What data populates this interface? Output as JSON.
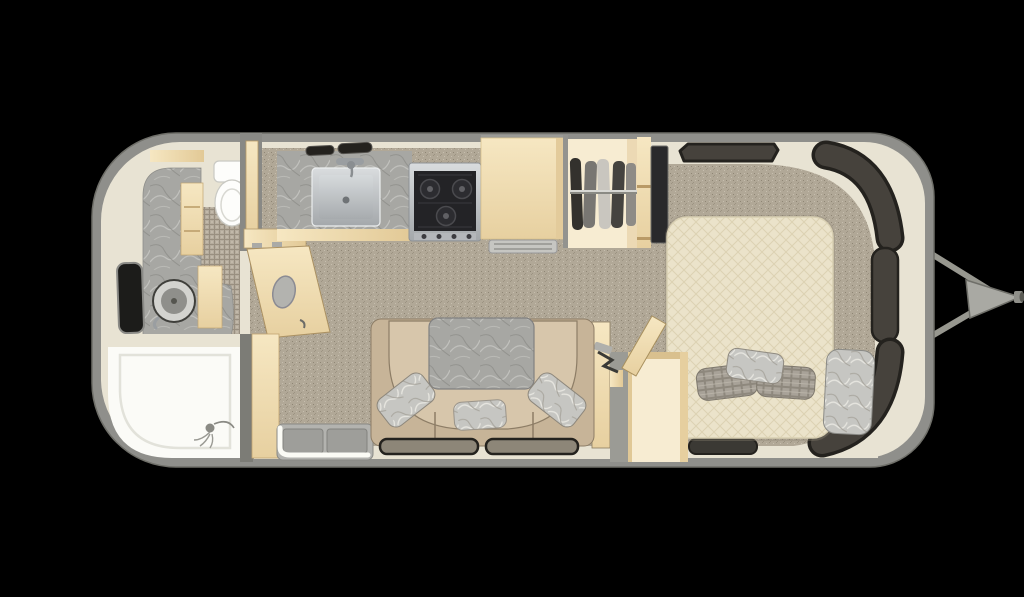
{
  "figure": {
    "type": "floor-plan",
    "subject": "travel-trailer-interior-top-down",
    "orientation": "hitch-on-right"
  },
  "palette": {
    "background": "#000000",
    "shell": "#8f8f8b",
    "shell_edge": "#6f6f69",
    "wall": "#e8e3d3",
    "wall_shade": "#d9d3c0",
    "carpet_base": "#b1a897",
    "carpet_dark": "#9c9382",
    "carpet_darker": "#8f8675",
    "carpet_light": "#c6beae",
    "tile_base": "#b5ac9d",
    "tile_grout": "#998f80",
    "tile_light": "#c2b9aa",
    "marble_base": "#a7a7a3",
    "marble_vein_light": "#c6c6c2",
    "marble_vein_dark": "#8e8e8a",
    "marble_light_base": "#c6c6c2",
    "marble_light_vein": "#eceae4",
    "marble_light_dark": "#a09c94",
    "quilt_base": "#ebe3ca",
    "quilt_line": "#dcd2b2",
    "plaid_base": "#a8a298",
    "plaid_line": "#8e887d",
    "plaid_light": "#bcb6ab",
    "wood_hi": "#f6e7c2",
    "wood_lo": "#e7d0a0",
    "wood_edge": "#c2a470",
    "steel_hi": "#d9dcde",
    "steel_lo": "#a4a8ab",
    "basin_hi": "#d6dadc",
    "basin_lo": "#a7abae",
    "window_dark": "#46423c",
    "window_outline": "#24221e",
    "window_black": "#1c1c1a",
    "sofa_base": "#c7b498",
    "sofa_seat": "#d7c6ab",
    "sofa_seam": "#8d7d66",
    "white": "#fbfbf7",
    "toilet_white": "#fdfdfb",
    "stove_black": "#232326",
    "tv_black": "#29292b",
    "led_white": "#fbfbf5",
    "doorway_gray": "#9b9b95",
    "alcove_cream": "#f7ecd2",
    "hitch_bar": "#97978f",
    "hitch_plate": "#a9a9a3",
    "garment_1": "#33312d",
    "garment_2": "#787672",
    "garment_3": "#c9c6bf",
    "garment_4": "#45433f",
    "garment_5": "#8e8b86",
    "sink_ring": "#d3d3cf"
  },
  "areas": {
    "exterior": {
      "fixtures": [
        "aluminum-shell",
        "a-frame-hitch",
        "coupler"
      ]
    },
    "bathroom": {
      "fixtures": [
        "vanity-counter",
        "round-sink",
        "toilet",
        "shower",
        "handheld-shower-head",
        "window",
        "wall-niche",
        "bathroom-door-open"
      ]
    },
    "kitchen": {
      "fixtures": [
        "marble-countertop",
        "square-sink",
        "faucet",
        "three-burner-cooktop",
        "range-vents",
        "refrigerator",
        "fridge-vent"
      ]
    },
    "wardrobe": {
      "fixtures": [
        "hanging-rod",
        "clothes-hangers",
        "shelf-column",
        "tv-panel"
      ]
    },
    "living": {
      "fixtures": [
        "u-shaped-dinette-sofa",
        "marble-table",
        "throw-pillows",
        "entry-step",
        "side-windows"
      ]
    },
    "bedroom": {
      "fixtures": [
        "bed-mattress",
        "bed-pillows",
        "marble-throw",
        "front-windows",
        "entry-door-open",
        "entry-alcove"
      ]
    }
  }
}
